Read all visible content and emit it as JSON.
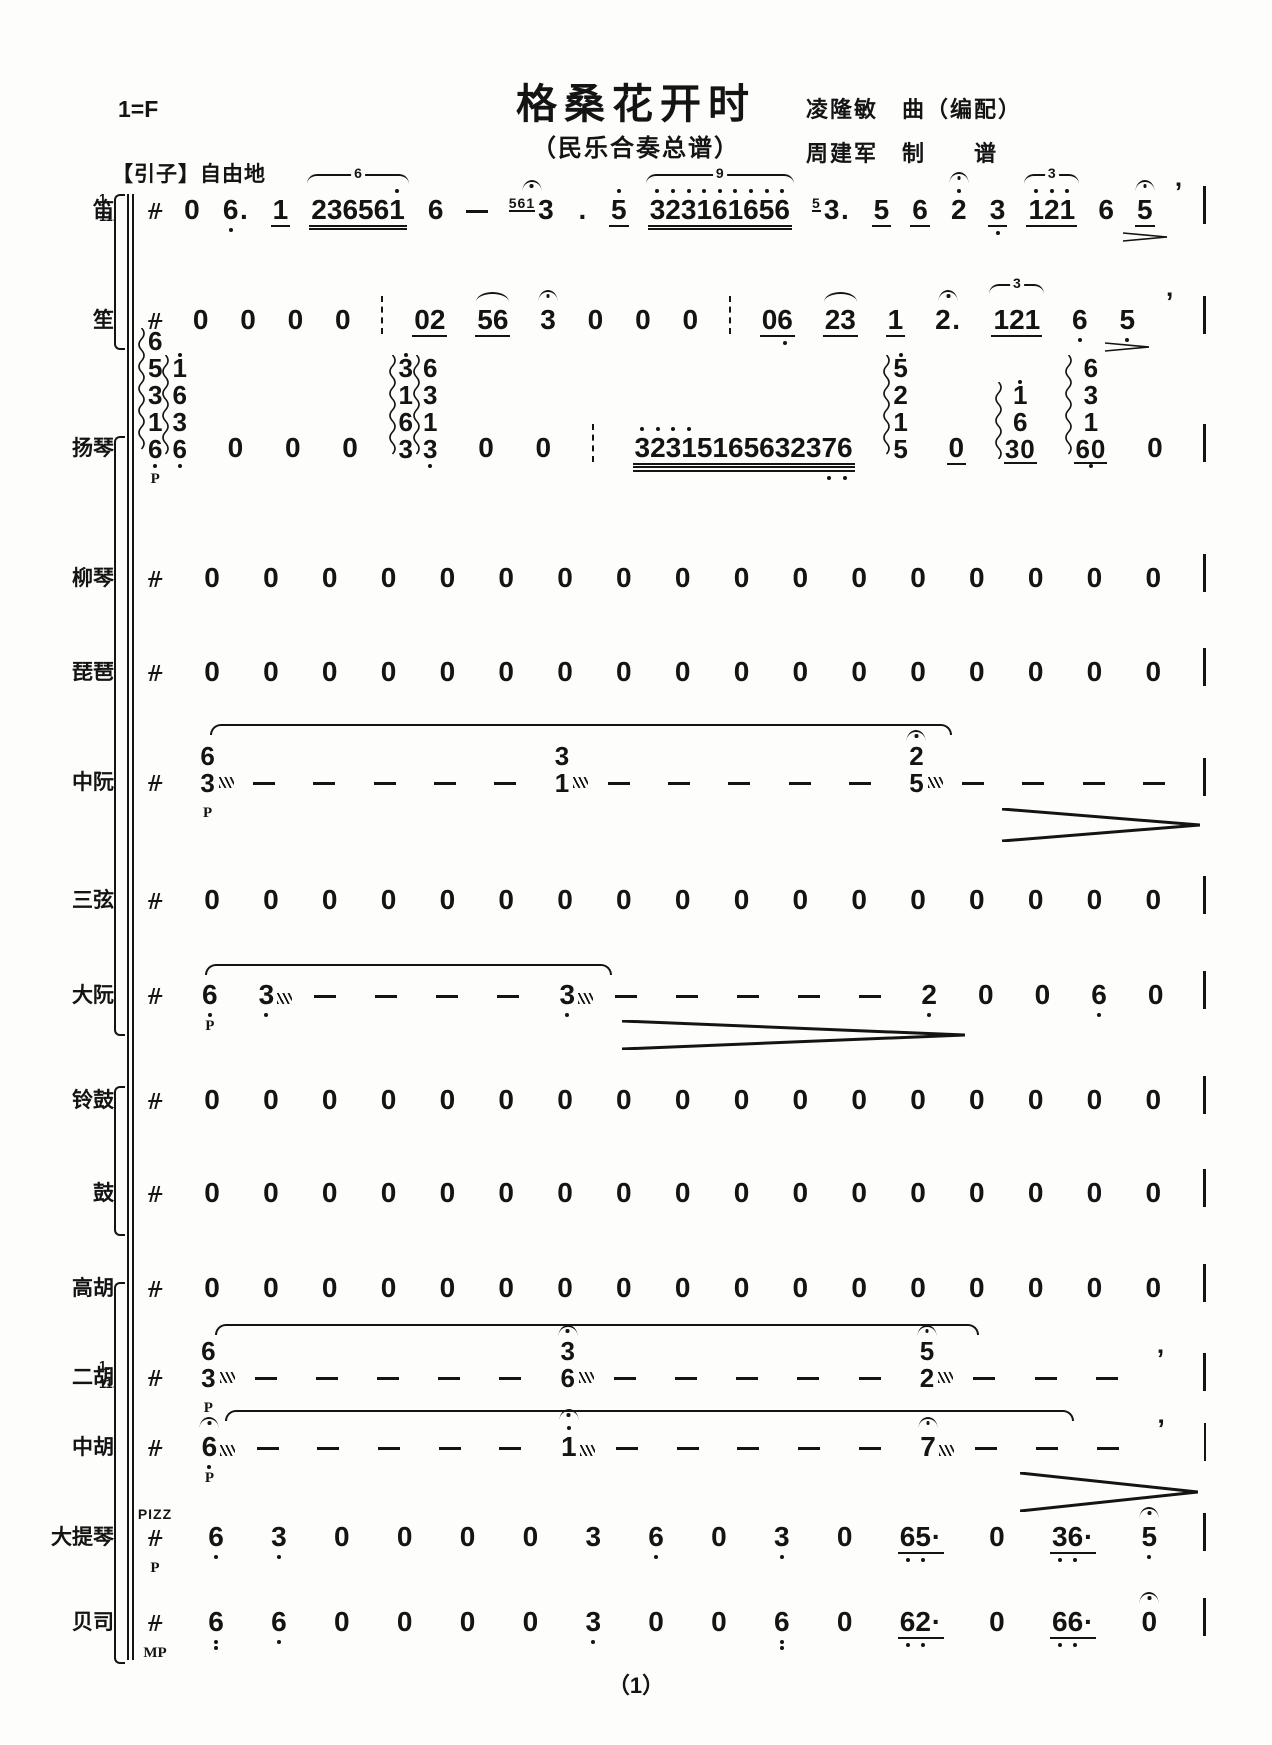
{
  "header": {
    "key": "1=F",
    "title": "格桑花开时",
    "subtitle": "（民乐合奏总谱）",
    "credit1": "凌隆敏　曲（编配）",
    "credit2": "周建军　制　　谱",
    "section": "【引子】自由地"
  },
  "page_number": "（1）",
  "colors": {
    "ink": "#141414",
    "paper": "#fdfdfb"
  },
  "meter_symbol": "sanban-free-meter",
  "staves": [
    {
      "id": "di",
      "label": "笛",
      "parts": [
        "1.",
        "11."
      ],
      "y": 220,
      "tokens": [
        {
          "g": "sanban"
        },
        {
          "n": "0"
        },
        {
          "n": "6.",
          "db": [
            0
          ]
        },
        {
          "n": "1",
          "u": 1
        },
        {
          "n": "236561",
          "u": 2,
          "tuplet": "6",
          "da": [
            5
          ]
        },
        {
          "n": "6"
        },
        {
          "g": "dash"
        },
        {
          "n": "3",
          "grace": "561",
          "ferm": true
        },
        {
          "n": "."
        },
        {
          "n": "5",
          "u": 1,
          "da": [
            0
          ]
        },
        {
          "n": "323161656",
          "u": 2,
          "tuplet": "9",
          "da": [
            0,
            1,
            2,
            3,
            4,
            5,
            6,
            7,
            8
          ]
        },
        {
          "n": "3.",
          "grace": "5"
        },
        {
          "n": "5",
          "u": 1
        },
        {
          "n": "6",
          "u": 1
        },
        {
          "n": "2",
          "da": [
            0
          ],
          "ferm": true
        },
        {
          "n": "3",
          "u": 1,
          "db": [
            0
          ]
        },
        {
          "n": "121",
          "u": 1,
          "tuplet": "3",
          "da": [
            0,
            1,
            2
          ]
        },
        {
          "n": "6"
        },
        {
          "n": "5",
          "u": 1,
          "ferm": true,
          "dim": true
        },
        {
          "g": "breath"
        },
        {
          "g": "bar"
        }
      ]
    },
    {
      "id": "sheng",
      "label": "笙",
      "y": 330,
      "tokens": [
        {
          "g": "sanban"
        },
        {
          "n": "0"
        },
        {
          "n": "0"
        },
        {
          "n": "0"
        },
        {
          "n": "0"
        },
        {
          "g": "dashbar"
        },
        {
          "n": "02",
          "u": 1
        },
        {
          "n": "56",
          "u": 1,
          "slur": true
        },
        {
          "n": "3",
          "ferm": true
        },
        {
          "n": "0"
        },
        {
          "n": "0"
        },
        {
          "n": "0"
        },
        {
          "g": "dashbar"
        },
        {
          "n": "06",
          "u": 1,
          "db": [
            1
          ]
        },
        {
          "n": "23",
          "u": 1,
          "slur": true
        },
        {
          "n": "1",
          "u": 1
        },
        {
          "n": "2.",
          "ferm": true
        },
        {
          "n": "121",
          "u": 1,
          "tuplet": "3"
        },
        {
          "n": "6",
          "db": [
            0
          ]
        },
        {
          "n": "5",
          "db": [
            0
          ],
          "dim": true
        },
        {
          "g": "breath"
        },
        {
          "g": "bar"
        }
      ]
    },
    {
      "id": "yangqin",
      "label": "扬琴",
      "y": 458,
      "tokens": [
        {
          "group": [
            {
              "stack": [
                {
                  "n": "6"
                },
                {
                  "n": "5"
                },
                {
                  "n": "3"
                },
                {
                  "n": "1"
                },
                {
                  "n": "6",
                  "db": [
                    0
                  ]
                }
              ],
              "arp": true,
              "dyn": "P"
            },
            {
              "stack": [
                {
                  "n": "1",
                  "da": [
                    0
                  ]
                },
                {
                  "n": "6"
                },
                {
                  "n": "3"
                },
                {
                  "n": "6",
                  "db": [
                    0
                  ]
                }
              ],
              "arp": true
            }
          ]
        },
        {
          "n": "0"
        },
        {
          "n": "0"
        },
        {
          "n": "0"
        },
        {
          "group": [
            {
              "stack": [
                {
                  "n": "3",
                  "da": [
                    0
                  ]
                },
                {
                  "n": "1"
                },
                {
                  "n": "6"
                },
                {
                  "n": "3"
                }
              ],
              "arp": true
            },
            {
              "stack": [
                {
                  "n": "6"
                },
                {
                  "n": "3"
                },
                {
                  "n": "1"
                },
                {
                  "n": "3",
                  "db": [
                    0
                  ]
                }
              ],
              "arp": true
            }
          ]
        },
        {
          "n": "0"
        },
        {
          "n": "0"
        },
        {
          "g": "dashbar"
        },
        {
          "n": "32315165632376",
          "u": 3,
          "da": [
            0,
            1,
            2,
            3
          ],
          "db": [
            12,
            13
          ]
        },
        {
          "stack": [
            {
              "n": "5",
              "da": [
                0
              ]
            },
            {
              "n": "2"
            },
            {
              "n": "1"
            },
            {
              "n": "5"
            }
          ],
          "arp": true
        },
        {
          "n": "0",
          "u": 1
        },
        {
          "stack": [
            {
              "n": "1",
              "da": [
                0
              ]
            },
            {
              "n": "6"
            },
            {
              "n": "30",
              "u": 1
            }
          ],
          "arp": true
        },
        {
          "stack": [
            {
              "n": "6"
            },
            {
              "n": "3"
            },
            {
              "n": "1"
            },
            {
              "n": "60",
              "u": 1,
              "db": [
                0
              ]
            }
          ],
          "arp": true
        },
        {
          "n": "0"
        },
        {
          "g": "bar"
        }
      ]
    },
    {
      "id": "liuqin",
      "label": "柳琴",
      "y": 588,
      "rest17": true
    },
    {
      "id": "pipa",
      "label": "琵琶",
      "y": 682,
      "rest17": true
    },
    {
      "id": "zhongruan",
      "label": "中阮",
      "y": 792,
      "tokens": [
        {
          "g": "sanban"
        },
        {
          "stack": [
            {
              "n": "6"
            },
            {
              "n": "3",
              "trem": true
            }
          ],
          "dyn": "P"
        },
        {
          "g": "dash"
        },
        {
          "g": "dash"
        },
        {
          "g": "dash"
        },
        {
          "g": "dash"
        },
        {
          "g": "dash"
        },
        {
          "stack": [
            {
              "n": "3"
            },
            {
              "n": "1",
              "trem": true
            }
          ]
        },
        {
          "g": "dash"
        },
        {
          "g": "dash"
        },
        {
          "g": "dash"
        },
        {
          "g": "dash"
        },
        {
          "g": "dash"
        },
        {
          "stack": [
            {
              "n": "2",
              "ferm": true
            },
            {
              "n": "5",
              "trem": true
            }
          ]
        },
        {
          "g": "dash"
        },
        {
          "g": "dash"
        },
        {
          "g": "dash"
        },
        {
          "g": "dash"
        },
        {
          "g": "bar"
        }
      ]
    },
    {
      "id": "sanxian",
      "label": "三弦",
      "y": 910,
      "rest17": true
    },
    {
      "id": "daruan",
      "label": "大阮",
      "y": 1005,
      "tokens": [
        {
          "g": "sanban"
        },
        {
          "n": "6",
          "db": [
            0
          ],
          "dyn": "P"
        },
        {
          "n": "3",
          "db": [
            0
          ],
          "trem": true
        },
        {
          "g": "dash"
        },
        {
          "g": "dash"
        },
        {
          "g": "dash"
        },
        {
          "g": "dash"
        },
        {
          "n": "3",
          "db": [
            0
          ],
          "trem": true
        },
        {
          "g": "dash"
        },
        {
          "g": "dash"
        },
        {
          "g": "dash"
        },
        {
          "g": "dash"
        },
        {
          "g": "dash"
        },
        {
          "n": "2",
          "db": [
            0
          ]
        },
        {
          "n": "0"
        },
        {
          "n": "0"
        },
        {
          "n": "6",
          "db": [
            0
          ]
        },
        {
          "n": "0"
        },
        {
          "g": "bar"
        }
      ]
    },
    {
      "id": "linggu",
      "label": "铃鼓",
      "y": 1110,
      "rest17": true
    },
    {
      "id": "gu",
      "label": "鼓",
      "y": 1203,
      "rest17": true
    },
    {
      "id": "gaohu",
      "label": "高胡",
      "y": 1298,
      "rest17": true
    },
    {
      "id": "erhu",
      "label": "二胡",
      "parts": [
        "1.",
        "11."
      ],
      "y": 1387,
      "tokens": [
        {
          "g": "sanban"
        },
        {
          "stack": [
            {
              "n": "6"
            },
            {
              "n": "3",
              "trem": true
            }
          ],
          "dyn": "P"
        },
        {
          "g": "dash"
        },
        {
          "g": "dash"
        },
        {
          "g": "dash"
        },
        {
          "g": "dash"
        },
        {
          "g": "dash"
        },
        {
          "stack": [
            {
              "n": "3",
              "ferm": true
            },
            {
              "n": "6",
              "trem": true
            }
          ]
        },
        {
          "g": "dash"
        },
        {
          "g": "dash"
        },
        {
          "g": "dash"
        },
        {
          "g": "dash"
        },
        {
          "g": "dash"
        },
        {
          "stack": [
            {
              "n": "5",
              "ferm": true
            },
            {
              "n": "2",
              "trem": true
            }
          ]
        },
        {
          "g": "dash"
        },
        {
          "g": "dash"
        },
        {
          "g": "dash"
        },
        {
          "g": "breath"
        },
        {
          "g": "bar"
        }
      ]
    },
    {
      "id": "zhonghu",
      "label": "中胡",
      "y": 1457,
      "tokens": [
        {
          "g": "sanban"
        },
        {
          "n": "6",
          "db": [
            0
          ],
          "ferm": true,
          "trem": true,
          "dyn": "P"
        },
        {
          "g": "dash"
        },
        {
          "g": "dash"
        },
        {
          "g": "dash"
        },
        {
          "g": "dash"
        },
        {
          "g": "dash"
        },
        {
          "n": "1",
          "da": [
            0
          ],
          "ferm": true,
          "trem": true
        },
        {
          "g": "dash"
        },
        {
          "g": "dash"
        },
        {
          "g": "dash"
        },
        {
          "g": "dash"
        },
        {
          "g": "dash"
        },
        {
          "n": "7",
          "ferm": true,
          "trem": true
        },
        {
          "g": "dash"
        },
        {
          "g": "dash"
        },
        {
          "g": "dash"
        },
        {
          "g": "breath"
        },
        {
          "g": "bar"
        }
      ]
    },
    {
      "id": "datiqin",
      "label": "大提琴",
      "y": 1547,
      "tokens": [
        {
          "g": "sanban",
          "above": "PIZZ",
          "dyn": "P"
        },
        {
          "n": "6",
          "db": [
            0
          ]
        },
        {
          "n": "3",
          "db": [
            0
          ]
        },
        {
          "n": "0"
        },
        {
          "n": "0"
        },
        {
          "n": "0"
        },
        {
          "n": "0"
        },
        {
          "n": "3"
        },
        {
          "n": "6",
          "db": [
            0
          ]
        },
        {
          "n": "0"
        },
        {
          "n": "3",
          "db": [
            0
          ]
        },
        {
          "n": "0"
        },
        {
          "n": "65·",
          "u": 1,
          "db": [
            0,
            1
          ]
        },
        {
          "n": "0"
        },
        {
          "n": "36·",
          "u": 1,
          "db": [
            0,
            1
          ]
        },
        {
          "n": "5",
          "db": [
            0
          ],
          "ferm": true
        },
        {
          "g": "bar"
        }
      ]
    },
    {
      "id": "beisi",
      "label": "贝司",
      "y": 1632,
      "tokens": [
        {
          "g": "sanban",
          "dyn": "MP"
        },
        {
          "n": "6",
          "ddb": [
            0
          ]
        },
        {
          "n": "6",
          "db": [
            0
          ]
        },
        {
          "n": "0"
        },
        {
          "n": "0"
        },
        {
          "n": "0"
        },
        {
          "n": "0"
        },
        {
          "n": "3",
          "db": [
            0
          ]
        },
        {
          "n": "0"
        },
        {
          "n": "0"
        },
        {
          "n": "6",
          "ddb": [
            0
          ]
        },
        {
          "n": "0"
        },
        {
          "n": "62·",
          "u": 1,
          "db": [
            0,
            1
          ]
        },
        {
          "n": "0"
        },
        {
          "n": "66·",
          "u": 1,
          "db": [
            0,
            1
          ]
        },
        {
          "n": "0",
          "ferm": true
        },
        {
          "g": "bar"
        }
      ]
    }
  ],
  "ties": [
    {
      "x1": 210,
      "x2": 948,
      "y": 724
    },
    {
      "x1": 205,
      "x2": 608,
      "y": 964
    },
    {
      "x1": 215,
      "x2": 975,
      "y": 1324
    },
    {
      "x1": 225,
      "x2": 1070,
      "y": 1410
    }
  ],
  "hairpins": [
    {
      "x1": 1002,
      "x2": 1200,
      "y": 808,
      "h": 34
    },
    {
      "x1": 622,
      "x2": 965,
      "y": 1020,
      "h": 30
    },
    {
      "x1": 1020,
      "x2": 1198,
      "y": 1472,
      "h": 40
    }
  ],
  "brackets": [
    {
      "y1": 194,
      "y2": 346
    },
    {
      "y1": 436,
      "y2": 1032
    },
    {
      "y1": 1086,
      "y2": 1232
    },
    {
      "y1": 1282,
      "y2": 1660
    }
  ],
  "system_line": {
    "x": 127,
    "y1": 194,
    "y2": 1660
  }
}
